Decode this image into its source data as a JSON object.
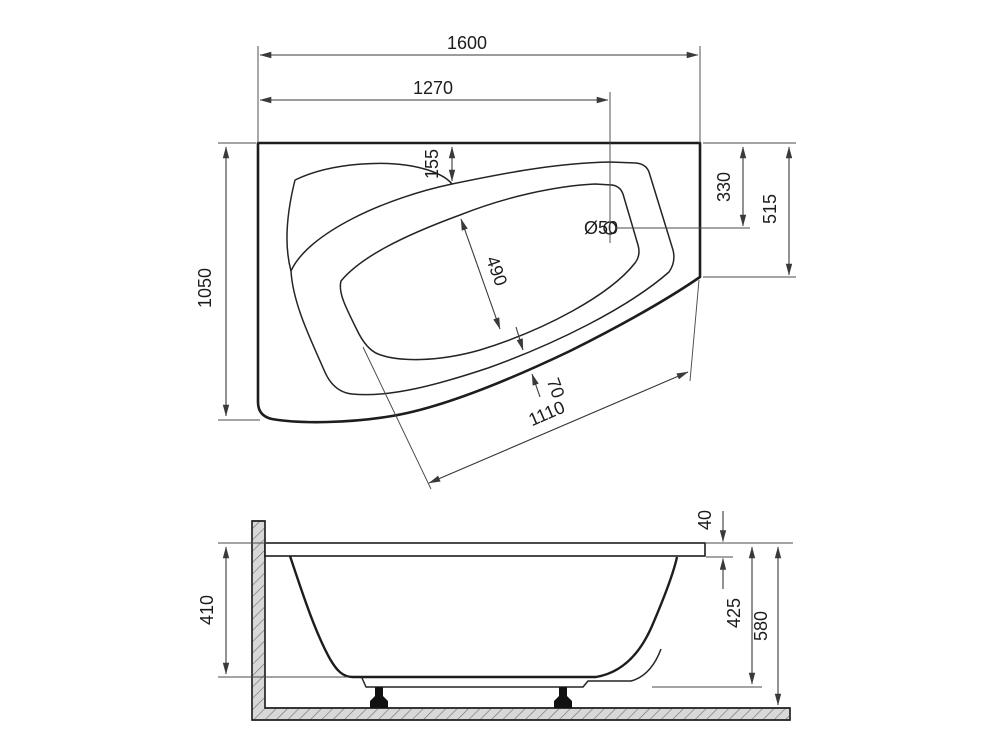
{
  "document": {
    "type": "technical-drawing",
    "subject": "asymmetric corner bathtub with dimensions, top view and side section view"
  },
  "colors": {
    "line": "#1d1d1d",
    "dimension_line": "#3a3a3a",
    "hatch_fill": "#d8d8d8",
    "hatch_stroke": "#6e6e6e",
    "background": "#ffffff"
  },
  "top_view": {
    "total_width": "1600",
    "drain_offset_x": "1270",
    "total_depth": "1050",
    "rim_to_top_edge": "155",
    "drain_offset_y": "330",
    "right_side_depth": "515",
    "basin_inner_width": "490",
    "rim_band_width": "70",
    "front_edge_length": "1110",
    "drain_diameter": "Ø50"
  },
  "side_view": {
    "inner_depth": "410",
    "rim_thickness": "40",
    "shell_height": "425",
    "total_height": "580"
  }
}
